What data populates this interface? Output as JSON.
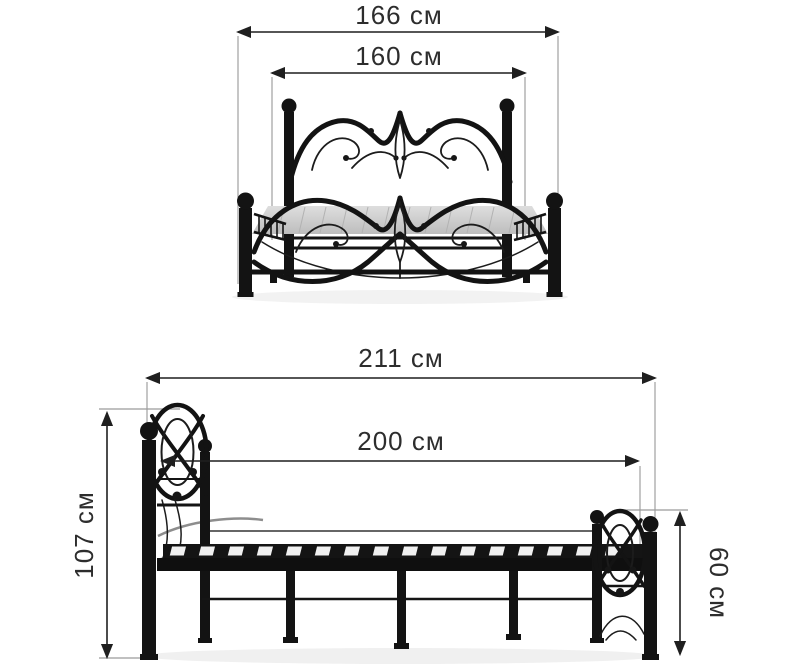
{
  "palette": {
    "background": "#ffffff",
    "dimension_line": "#1f1f1f",
    "extension_line": "#8c8c8c",
    "label_text": "#2d2d2d",
    "bed_metal": "#131313",
    "mattress_deck": "#cfcfcf"
  },
  "views": {
    "front": {
      "dimensions": [
        {
          "id": "overall_width",
          "label": "166 см",
          "value": 166,
          "unit": "см"
        },
        {
          "id": "mattress_width",
          "label": "160 см",
          "value": 160,
          "unit": "см"
        }
      ]
    },
    "side": {
      "dimensions": [
        {
          "id": "overall_length",
          "label": "211 см",
          "value": 211,
          "unit": "см"
        },
        {
          "id": "mattress_length",
          "label": "200 см",
          "value": 200,
          "unit": "см"
        },
        {
          "id": "headboard_height",
          "label": "107 см",
          "value": 107,
          "unit": "см"
        },
        {
          "id": "footboard_height",
          "label": "60 см",
          "value": 60,
          "unit": "см"
        }
      ]
    }
  }
}
